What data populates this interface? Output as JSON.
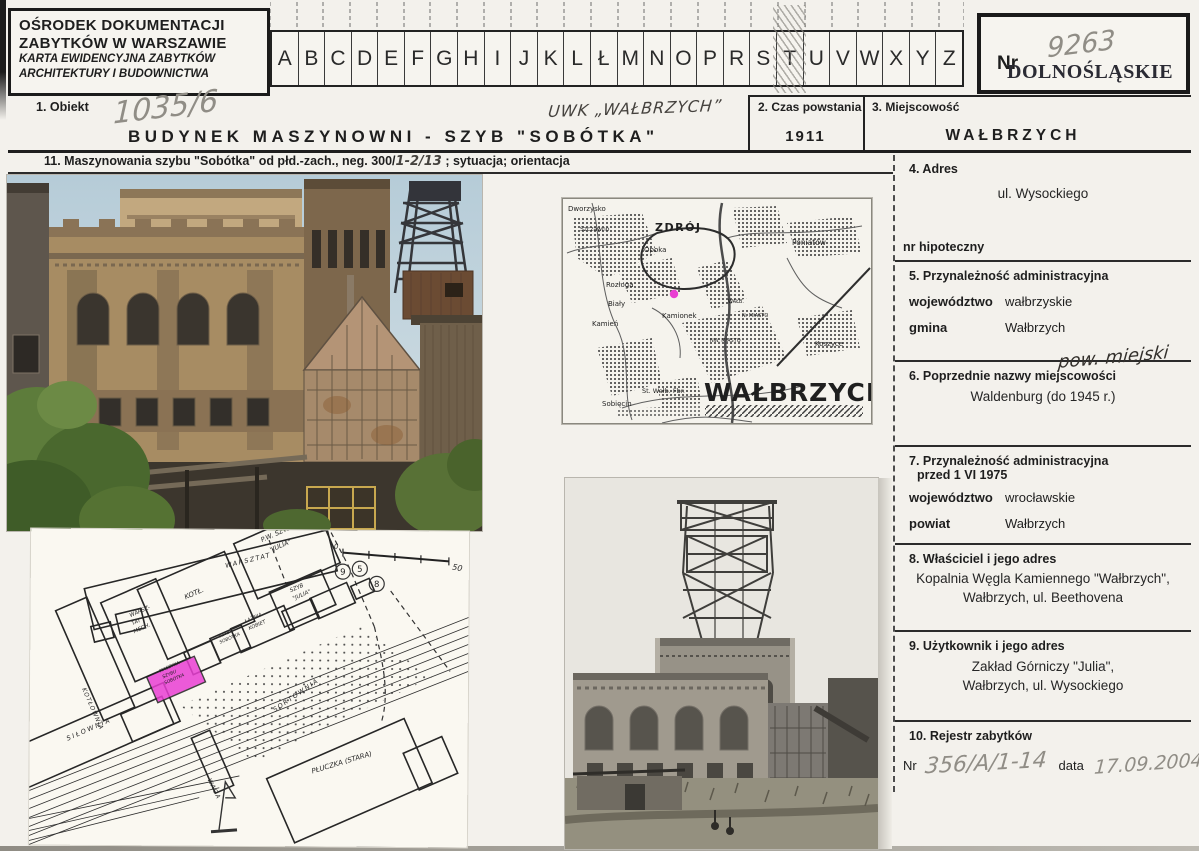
{
  "header": {
    "line1": "OŚRODEK DOKUMENTACJI",
    "line2": "ZABYTKÓW W WARSZAWIE",
    "line3": "KARTA EWIDENCYJNA ZABYTKÓW",
    "line4": "ARCHITEKTURY I BUDOWNICTWA"
  },
  "index_strip": {
    "letters": [
      "A",
      "B",
      "C",
      "D",
      "E",
      "F",
      "G",
      "H",
      "I",
      "J",
      "K",
      "L",
      "Ł",
      "M",
      "N",
      "O",
      "P",
      "R",
      "S",
      "T",
      "U",
      "V",
      "W",
      "X",
      "Y",
      "Z"
    ],
    "hatched_letter": "T"
  },
  "nr_box": {
    "label": "Nr",
    "number": "9263",
    "stamp": "DOLNOŚLĄSKIE"
  },
  "object_row": {
    "label": "1. Obiekt",
    "number": "1035/6",
    "annotation": "UWK „WAŁBRZYCH”",
    "title": "BUDYNEK MASZYNOWNI - SZYB \"SOBÓTKA\""
  },
  "czas": {
    "label": "2. Czas powstania",
    "value": "1911"
  },
  "miejscowosc": {
    "label": "3. Miejscowość",
    "value": "WAŁBRZYCH"
  },
  "caption": {
    "prefix": "11. Maszynowania szybu \"Sobótka\" od płd.-zach., neg. 300/",
    "neg": "1-2/13",
    "suffix": "; sytuacja; orientacja"
  },
  "fields": {
    "adres": {
      "label": "4. Adres",
      "value": "ul. Wysockiego",
      "hipoteczny": "nr hipoteczny"
    },
    "przynaleznosc": {
      "label": "5. Przynależność administracyjna",
      "wojewodztwo_label": "województwo",
      "wojewodztwo": "wałbrzyskie",
      "gmina_label": "gmina",
      "gmina": "Wałbrzych",
      "handwritten": "pow. miejski"
    },
    "poprzednie": {
      "label": "6. Poprzednie nazwy miejscowości",
      "value": "Waldenburg (do 1945 r.)"
    },
    "przyn_1975": {
      "label": "7. Przynależność administracyjna",
      "label2": "przed 1 VI 1975",
      "wojewodztwo_label": "województwo",
      "wojewodztwo": "wrocławskie",
      "powiat_label": "powiat",
      "powiat": "Wałbrzych"
    },
    "wlasciciel": {
      "label": "8. Właściciel i jego adres",
      "line1": "Kopalnia Węgla Kamiennego \"Wałbrzych\",",
      "line2": "Wałbrzych, ul. Beethovena"
    },
    "uzytkownik": {
      "label": "9. Użytkownik i jego adres",
      "line1": "Zakład Górniczy \"Julia\",",
      "line2": "Wałbrzych, ul. Wysockiego"
    },
    "rejestr": {
      "label": "10. Rejestr zabytków",
      "nr_label": "Nr",
      "nr": "356/A/1-14",
      "data_label": "data",
      "data": "17.09.2004"
    }
  },
  "map": {
    "dworzysko": "Dworzysko",
    "szczawno": "Szczawno",
    "zdroj": "ZDRÓJ",
    "opoka": "Opoka",
    "poniatow": "Poniatów",
    "rozloga": "Rozłoga",
    "bialy": "Biały",
    "kamien": "Kamień",
    "kamionek": "Kamionek",
    "walb": "WAŁB.",
    "n_miasto": "N. MIASTO",
    "nw_miasto": "NW. MIASTO",
    "koszyce": "Koszyce",
    "st_walb": "St. Wałb. Fbr.",
    "sobiecin": "Sobięcin",
    "big": "WAŁBRZYCH"
  },
  "site_plan": {
    "warsztat": "WARSZTAT",
    "pw_l1": "P.W. SZYB",
    "pw_l2": "\"JULIA\"",
    "kotlownia": "KOTŁOWNIA",
    "wm_l1": "WARSZ-",
    "wm_l2": "TAT",
    "wm_l3": "MECH.",
    "kotl": "KOTŁ.",
    "sj_l1": "SZYB",
    "sj_l2": "\"JULIA\"",
    "lk_l1": "ŁAŹNIA",
    "lk_l2": "KOBIET",
    "ss_l1": "SZYB",
    "ss_l2": "SOBÓTKA",
    "m_l1": "MASZYNA",
    "m_l2": "SZYBU",
    "m_l3": "SOBÓTKA",
    "silownia": "SIŁOWNIA",
    "waga": "WAGA",
    "sortownia": "SORTOWNIA",
    "pluczka": "PŁUCZKA (STARA)",
    "scale_start": "0",
    "scale_end": "50",
    "b1": "9",
    "b2": "5",
    "b3": "8"
  },
  "colors": {
    "highlight_magenta": "#e93fd2",
    "stamp_ink": "#2b2b34",
    "pencil": "#908d86"
  }
}
